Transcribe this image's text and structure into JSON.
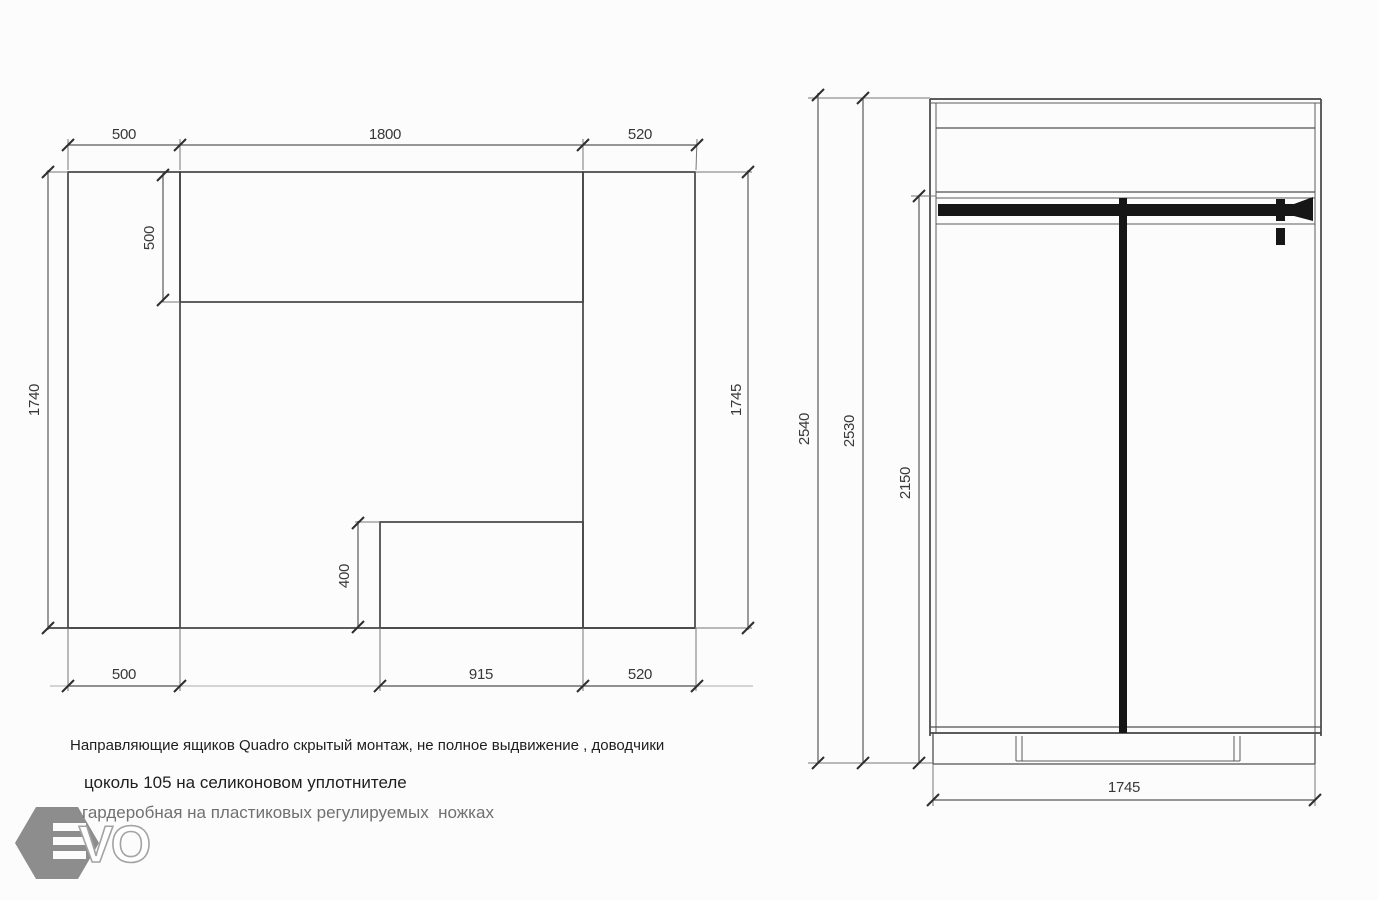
{
  "left_view": {
    "dim_top_left": "500",
    "dim_top_middle": "1800",
    "dim_top_right": "520",
    "dim_left_height": "1740",
    "dim_inner_top_depth": "500",
    "dim_right_height": "1745",
    "dim_inner_box_height": "400",
    "dim_bottom_left": "500",
    "dim_bottom_middle": "915",
    "dim_bottom_right": "520"
  },
  "right_view": {
    "dim_overall_height": "2540",
    "dim_body_height": "2530",
    "dim_hanging_height": "2150",
    "dim_width": "1745"
  },
  "notes": {
    "line1": "Направляющие ящиков Quadro скрытый монтаж, не полное выдвижение , доводчики",
    "line2": "цоколь 105 на селиконовом уплотнителе",
    "line3": "гардеробная на пластиковых регулируемых  ножках"
  },
  "logo": {
    "letter_v": "V",
    "letter_o": "O"
  },
  "colors": {
    "line": "#454545",
    "accent_black": "#161616",
    "logo_gray": "#8d8d8d",
    "text_dark": "#1e1e1e",
    "text_gray": "#707070"
  }
}
